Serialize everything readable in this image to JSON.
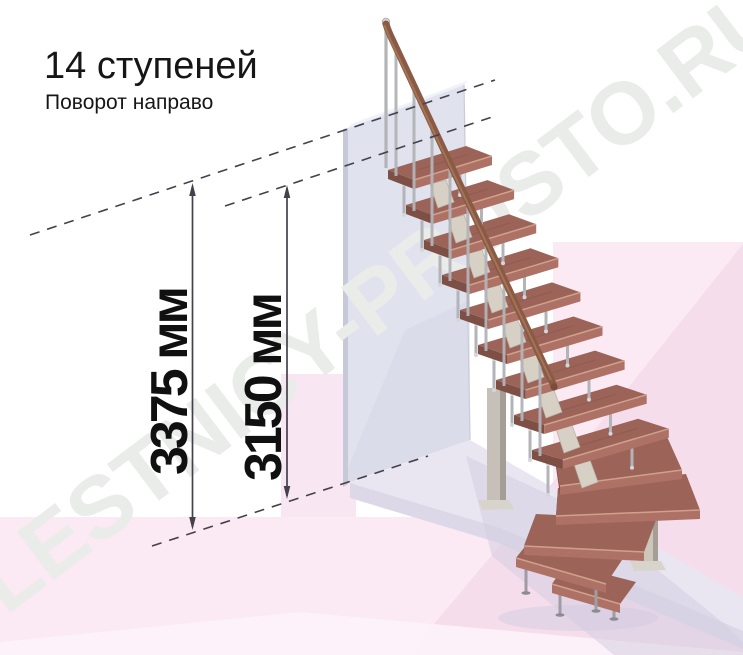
{
  "title": "14 ступеней",
  "subtitle": "Поворот направо",
  "watermark": "LESTNICY-PROSTO.RU",
  "dimensions": {
    "overall_height": {
      "label": "3375 мм",
      "value": 3375,
      "unit": "мм"
    },
    "floor_to_top_step": {
      "label": "3150 мм",
      "value": 3150,
      "unit": "мм"
    }
  },
  "stairs": {
    "total_steps": 14,
    "straight_steps": 9,
    "winder_steps": 3,
    "bottom_steps": 2,
    "turn_direction": "направо"
  },
  "colors": {
    "background": "#ffffff",
    "floor_pink": "#fbe9f4",
    "floor_pink_deep": "#f5ddec",
    "back_panel_pink": "#f8e7f2",
    "floor_light_band": "#fdf3f9",
    "wall_face": "#e0e2ee",
    "wall_edge": "#c6c9d8",
    "wall_top": "#f1f2f8",
    "slab_top": "#e9e6f2",
    "slab_front": "#dcd8e8",
    "shadow": "#d1cbdf",
    "tread_top": "#9c6358",
    "tread_front": "#ad7265",
    "tread_side": "#7d4f45",
    "tread_edge_highlight": "#cfa18c",
    "tread_grain": "#875349",
    "handrail": "#8a5a44",
    "handrail_highlight": "#ab7c5e",
    "metal_post": "#b3b4b8",
    "metal_joint": "#d6d6da",
    "bracket_cream": "#d7d0c4",
    "bracket_edge": "#b9b1a3",
    "column_steel": "#c6c0b8",
    "column_steel_dark": "#a49e96",
    "column_plate": "#d9d4cb",
    "leg_metal": "#9d9da3",
    "dim_line": "#46404c",
    "text_dark": "#161616",
    "watermark_gray": "#e9ece9"
  }
}
